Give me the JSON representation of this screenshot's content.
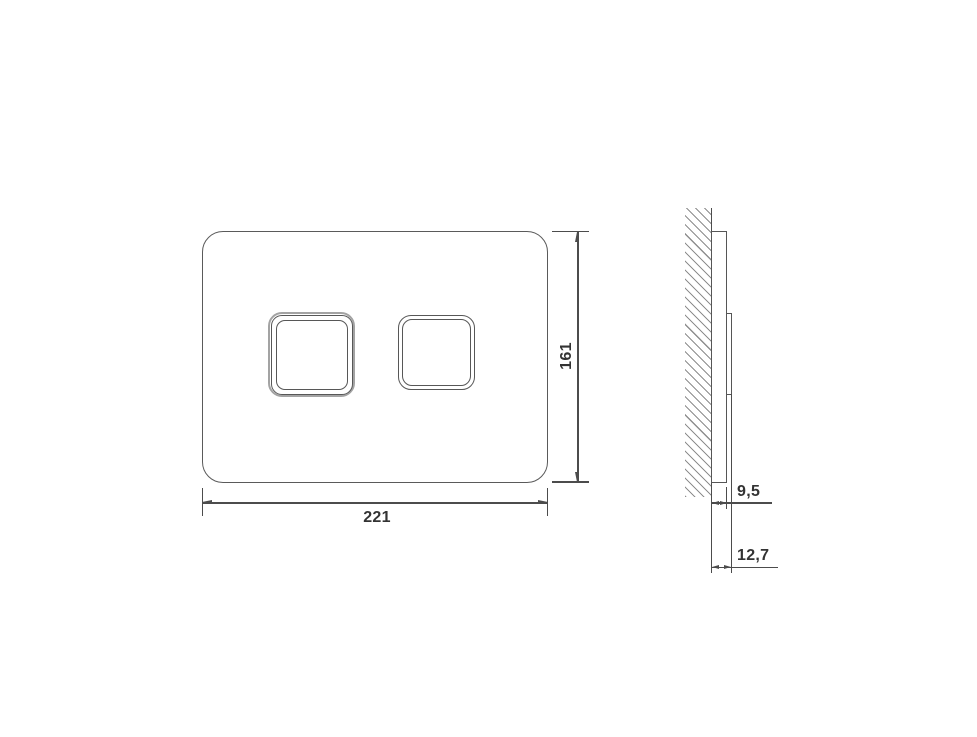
{
  "front_view": {
    "height_dim": "161",
    "width_dim": "221"
  },
  "side_view": {
    "plate_depth_dim": "9,5",
    "total_depth_dim": "12,7"
  },
  "colors": {
    "outline": "#565656",
    "button_ring": "#a3a3a3",
    "dimension_line": "#4c4c4c",
    "label_text": "#333333",
    "hatch": "#8e8e8e",
    "background": "#ffffff"
  }
}
